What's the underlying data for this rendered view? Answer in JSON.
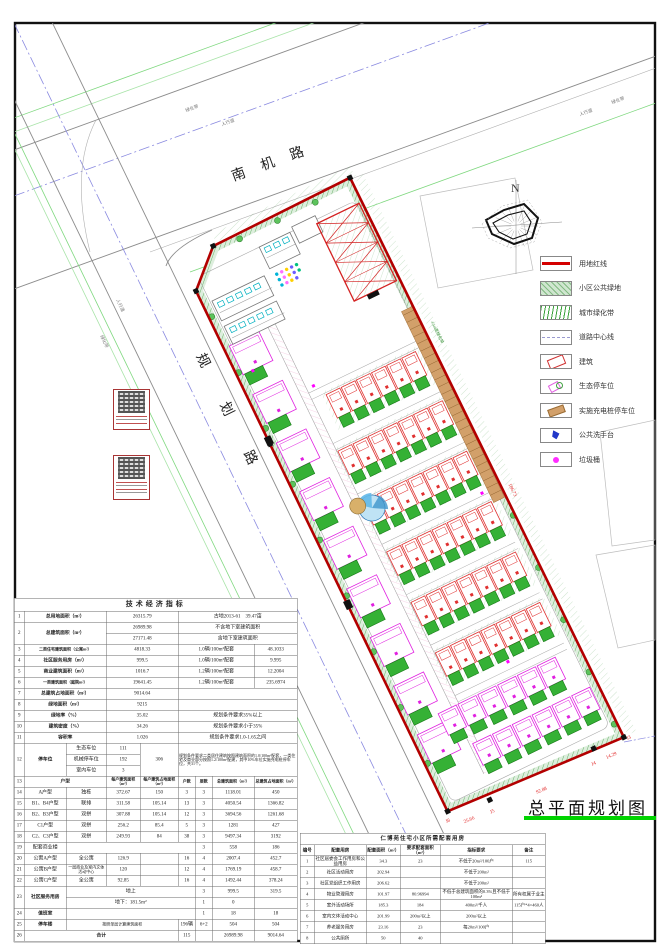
{
  "page": {
    "sheet_title": "总平面规划图"
  },
  "north_label": "N",
  "roads": {
    "top": "南机路",
    "left": "规划路",
    "greenbelt": "绿化带",
    "sidewalk": "人行道"
  },
  "colors": {
    "boundary_red": "#b30000",
    "garden_green": "#35b135",
    "title_underline_green": "#00d400",
    "magenta": "#ff00ff",
    "cyan": "#00b0c0",
    "parking_tan": "#d2a06a"
  },
  "legend": {
    "items": [
      {
        "icon": "red-line-swatch",
        "label": "用地红线"
      },
      {
        "icon": "public-green-swatch",
        "label": "小区公共绿地"
      },
      {
        "icon": "city-greenbelt-swatch",
        "label": "城市绿化带"
      },
      {
        "icon": "road-centerline-swatch",
        "label": "道路中心线"
      },
      {
        "icon": "building-swatch",
        "label": "建筑"
      },
      {
        "icon": "eco-parking-swatch",
        "label": "生态停车位"
      },
      {
        "icon": "charging-parking-swatch",
        "label": "实施充电桩停车位"
      },
      {
        "icon": "wash-station-swatch",
        "label": "公共洗手台"
      },
      {
        "icon": "trash-bin-swatch",
        "label": "垃圾桶"
      }
    ]
  },
  "site_annotations": {
    "dim_right": "186.73",
    "dim_bottom": "92.88",
    "dim_bottom2": "25.66",
    "dim_bottom3": "14.29",
    "j3": "J3",
    "j4": "J4",
    "j5": "J5",
    "j6": "J6",
    "greenbelt_note": "4.5m宽绿化带"
  },
  "ind_table": {
    "title": "技术经济指标",
    "rows": [
      [
        "1",
        {
          "t": "总用地面积（m²）",
          "cs": 2,
          "cl": "lab"
        },
        {
          "t": "26315.79",
          "cs": 2
        },
        {
          "t": "古地2013-61　39.47亩",
          "cs": 4
        }
      ],
      [
        {
          "t": "2",
          "rs": 2
        },
        {
          "t": "总建筑面积（m²）",
          "cs": 2,
          "rs": 2,
          "cl": "lab"
        },
        {
          "t": "26989.98",
          "cs": 2
        },
        {
          "t": "不含地下室建筑面积",
          "cs": 4
        }
      ],
      [
        {
          "t": "27171.48",
          "cs": 2
        },
        {
          "t": "含地下室建筑面积",
          "cs": 4
        }
      ],
      [
        "3",
        {
          "t": "二类住宅建筑面积（公寓m²）",
          "cs": 2,
          "cl": "lab sm"
        },
        {
          "t": "4818.33",
          "cs": 2
        },
        {
          "t": "1.0辆/100m²配套",
          "cs": 3
        },
        "48.1033"
      ],
      [
        "4",
        {
          "t": "社区服务用房（m²）",
          "cs": 2,
          "cl": "lab"
        },
        {
          "t": "999.5",
          "cs": 2
        },
        {
          "t": "1.0辆/100m²配套",
          "cs": 3
        },
        "9.995"
      ],
      [
        "5",
        {
          "t": "商业建筑面积（m²）",
          "cs": 2,
          "cl": "lab"
        },
        {
          "t": "1016.7",
          "cs": 2
        },
        {
          "t": "1.2辆/100m²配套",
          "cs": 3
        },
        "12.2004"
      ],
      [
        "6",
        {
          "t": "一类建筑面积（庭院m²）",
          "cs": 2,
          "cl": "lab sm"
        },
        {
          "t": "19641.45",
          "cs": 2
        },
        {
          "t": "1.2辆/100m²配套",
          "cs": 3
        },
        "235.6974"
      ],
      [
        "7",
        {
          "t": "总建筑占地面积（m²）",
          "cs": 2,
          "cl": "lab"
        },
        {
          "t": "9014.64",
          "cs": 2
        },
        {
          "t": "",
          "cs": 4
        }
      ],
      [
        "8",
        {
          "t": "绿地面积（m²）",
          "cs": 2,
          "cl": "lab"
        },
        {
          "t": "9215",
          "cs": 2
        },
        {
          "t": "",
          "cs": 4
        }
      ],
      [
        "9",
        {
          "t": "绿地率（%）",
          "cs": 2,
          "cl": "lab"
        },
        {
          "t": "35.02",
          "cs": 2
        },
        {
          "t": "规划条件要求35%以上",
          "cs": 4
        }
      ],
      [
        "10",
        {
          "t": "建筑密度（%）",
          "cs": 2,
          "cl": "lab"
        },
        {
          "t": "34.26",
          "cs": 2
        },
        {
          "t": "规划条件要求小于35%",
          "cs": 4
        }
      ],
      [
        "11",
        {
          "t": "容积率",
          "cs": 2,
          "cl": "lab"
        },
        {
          "t": "1.026",
          "cs": 2
        },
        {
          "t": "规划条件要求1.0-1.65之间",
          "cs": 4
        }
      ],
      [
        {
          "t": "12",
          "rs": 3
        },
        {
          "t": "停车位",
          "rs": 3,
          "cl": "lab"
        },
        "生态车位",
        "111",
        {
          "t": "306",
          "rs": 3
        },
        {
          "t": "规划条件要求二类居住建筑按照建筑面积的1.0/100m²配套，一类住宅及商业部分按照1.2/100m²配建，其中10%车位实施充电桩停车位，共31个。",
          "cs": 4,
          "rs": 3,
          "cl": "rem"
        }
      ],
      [
        "机械停车位",
        "192"
      ],
      [
        "室内车位",
        "3"
      ],
      [
        "13",
        {
          "t": "户型",
          "cs": 2,
          "cl": "lab"
        },
        {
          "t": "每户建筑面积（m²）",
          "cl": "lab sm"
        },
        {
          "t": "每户建筑占地面积（m²）",
          "cl": "lab sm"
        },
        {
          "t": "户数",
          "cl": "lab sm"
        },
        {
          "t": "层数",
          "cl": "lab sm"
        },
        {
          "t": "总建筑面积（m²）",
          "cl": "lab sm"
        },
        {
          "t": "总建筑占地面积（m²）",
          "cl": "lab sm"
        }
      ],
      [
        "14",
        "A户型",
        "独栋",
        "372.67",
        "150",
        "3",
        "3",
        "1118.01",
        "450"
      ],
      [
        "15",
        "B1、B4户型",
        "联排",
        "311.58",
        "105.14",
        "13",
        "3",
        "4050.54",
        "1366.82"
      ],
      [
        "16",
        "B2、B3户型",
        "双拼",
        "307.88",
        "105.14",
        "12",
        "3",
        "3694.56",
        "1261.68"
      ],
      [
        "17",
        "C1户型",
        "双拼",
        "256.2",
        "85.4",
        "5",
        "3",
        "1281",
        "427"
      ],
      [
        "18",
        "C2、C3户型",
        "双拼",
        "249.93",
        "84",
        "38",
        "3",
        "9497.34",
        "3192"
      ],
      [
        "19",
        "配套商业楼",
        {
          "t": "",
          "cs": 4
        },
        "3",
        "558",
        "186"
      ],
      [
        "20",
        "公寓A户型",
        "全公寓",
        "126.9",
        "",
        "16",
        "4",
        "2007.4",
        "452.7"
      ],
      [
        "21",
        "公寓B户型",
        {
          "t": "一层商业及室内文体活动中心",
          "cl": "sm"
        },
        "120",
        "",
        "12",
        "4",
        "1769.19",
        "458.7"
      ],
      [
        "22",
        "公寓C户型",
        "全公寓",
        "92.85",
        "",
        "16",
        "4",
        "1492.44",
        "378.24"
      ],
      [
        {
          "t": "23",
          "rs": 2
        },
        {
          "t": "社区服务用房",
          "rs": 2,
          "cl": "lab"
        },
        {
          "t": "地上",
          "cs": 4
        },
        "3",
        "999.5",
        "319.5"
      ],
      [
        {
          "t": "地下：181.5m²",
          "cs": 4
        },
        "1",
        "0",
        ""
      ],
      [
        "24",
        {
          "t": "值班室",
          "cl": "lab"
        },
        {
          "t": "",
          "cs": 4
        },
        "1",
        "18",
        "18"
      ],
      [
        "25",
        {
          "t": "停车楼",
          "cl": "lab"
        },
        {
          "t": "按照单层计算建筑面积",
          "cs": 3,
          "cl": "sm"
        },
        "196辆",
        "6+2",
        "504",
        "504"
      ],
      [
        "26",
        {
          "t": "合计",
          "cs": 4,
          "cl": "lab"
        },
        "115",
        "",
        "26989.98",
        "9014.64"
      ]
    ]
  },
  "support_table": {
    "title": "仁博苑住宅小区所需配套用房",
    "header": [
      "编号",
      "配套用房",
      "配套面积（m²）",
      "要求配套面积（m²）",
      "指标要求",
      "备注"
    ],
    "rows": [
      [
        "1",
        "社区居委会工作用房和公益用房",
        "34.3",
        "23",
        "不低于20m²/100户",
        "115"
      ],
      [
        "2",
        "社区活动用房",
        "202.94",
        "",
        "不低于200m²",
        ""
      ],
      [
        "3",
        "社区党组织工作用房",
        "206.62",
        "",
        "不低于200m²",
        ""
      ],
      [
        "4",
        "物业管理用房",
        "101.97",
        "80.96994",
        "不低于总建筑面积的0.3%且不低于100m²",
        "所有权属于业主"
      ],
      [
        "5",
        "室外活动场所",
        "185.3",
        "184",
        "400m²/千人",
        "115户*4=460人"
      ],
      [
        "6",
        "室内文体活动中心",
        "201.99",
        "200m²以上",
        "200m²以上",
        ""
      ],
      [
        "7",
        "养老服务用房",
        "23.16",
        "23",
        "每20m²/100户",
        ""
      ],
      [
        "8",
        "公共厕所",
        "50",
        "40",
        "",
        ""
      ]
    ]
  }
}
